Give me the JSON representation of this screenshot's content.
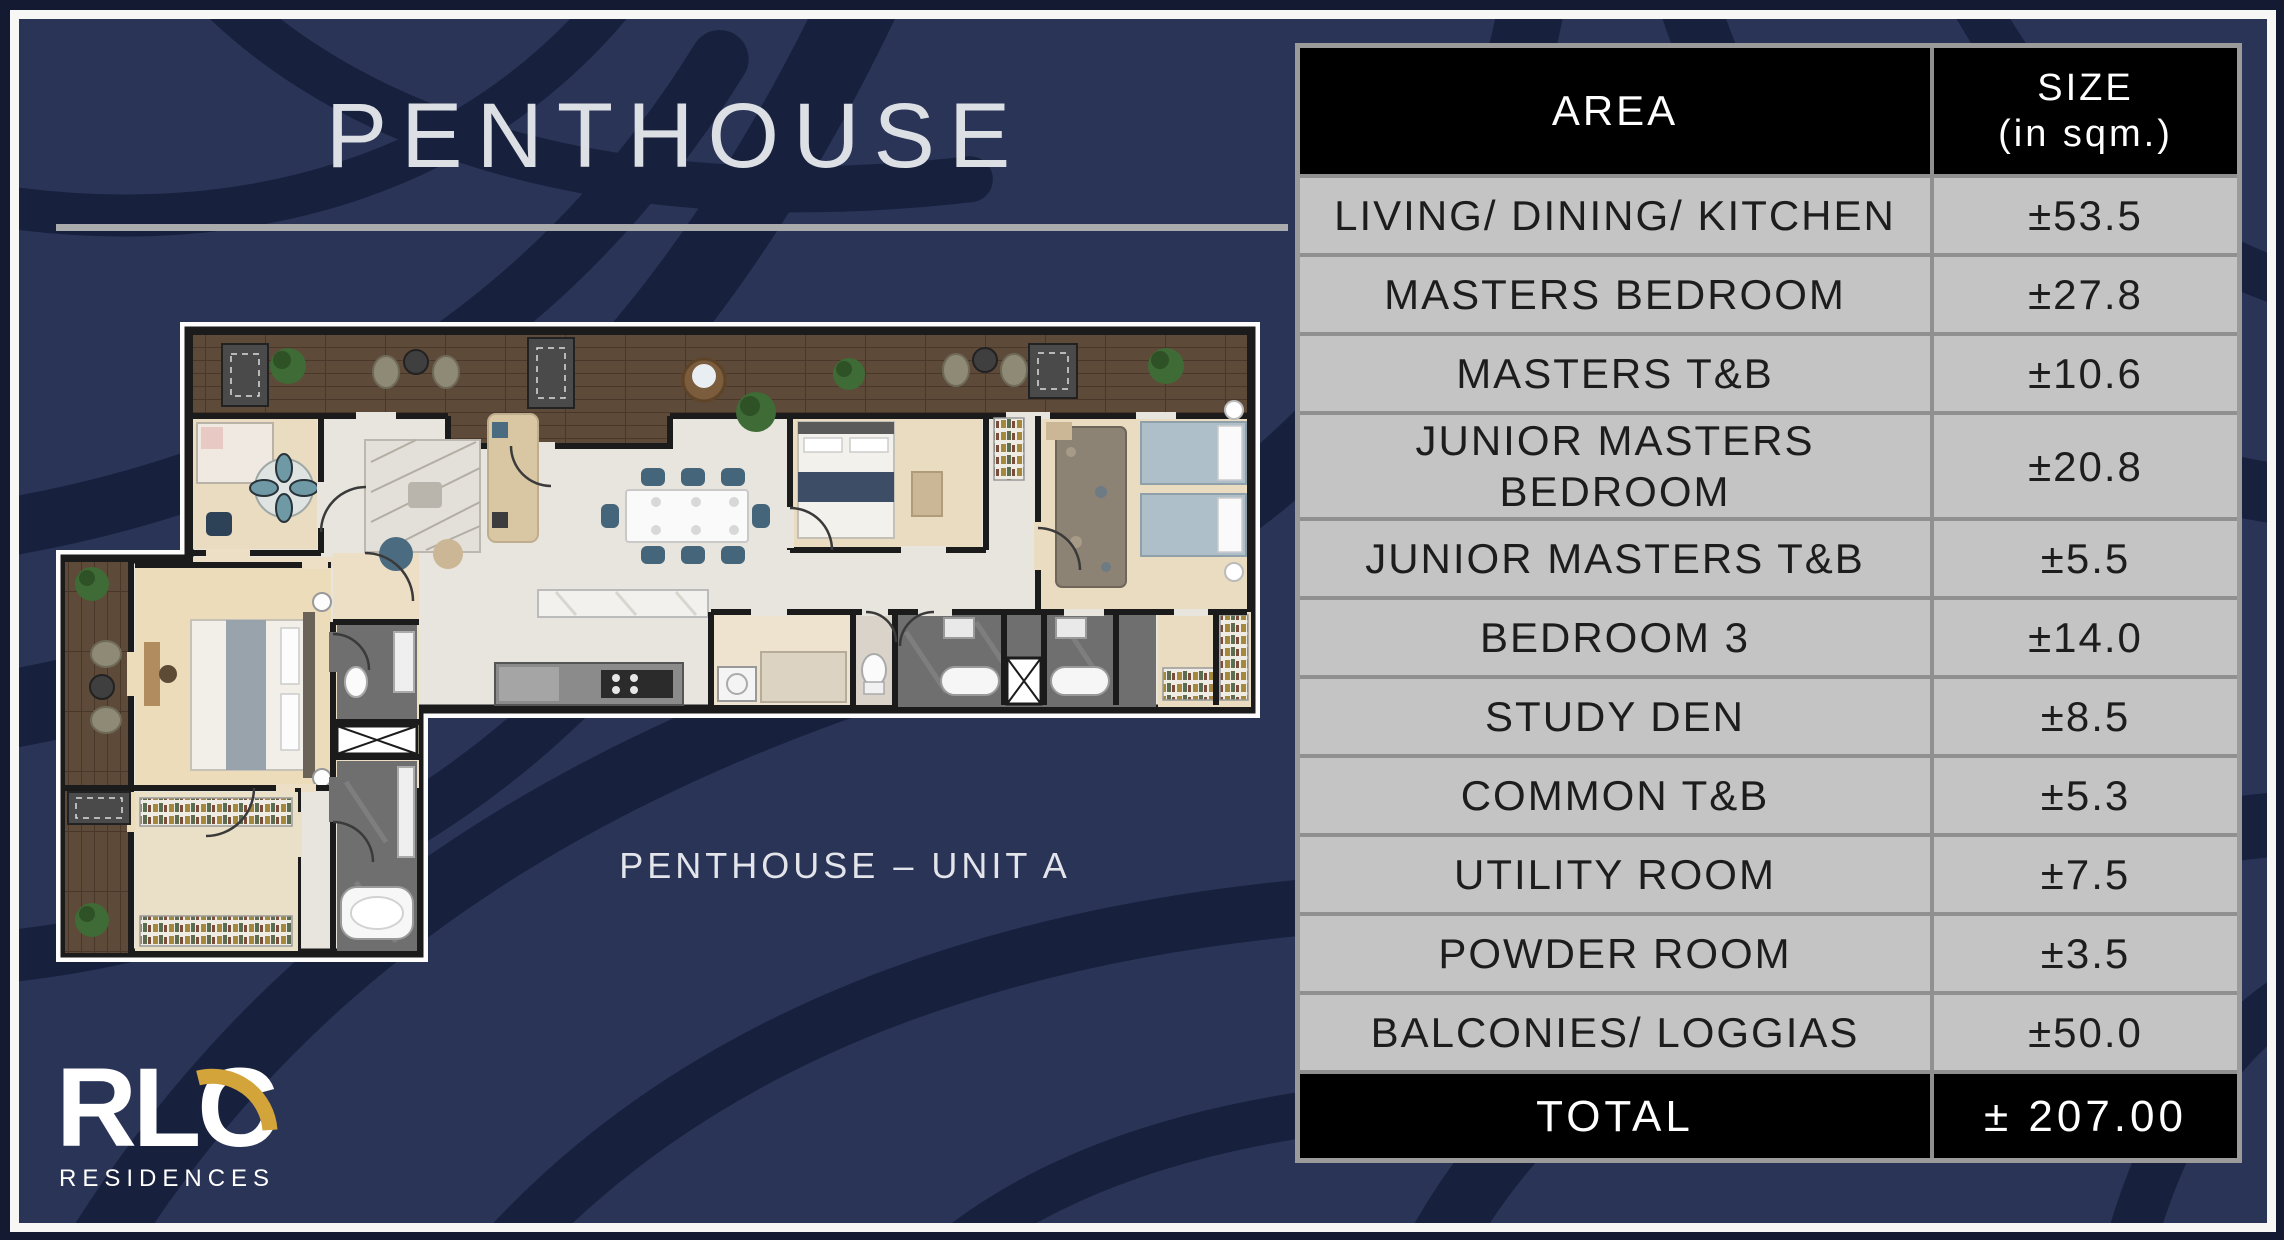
{
  "slide": {
    "title": "PENTHOUSE",
    "caption": "PENTHOUSE – UNIT A"
  },
  "logo": {
    "brand": "RLC",
    "subtitle": "RESIDENCES"
  },
  "table": {
    "header": {
      "area": "AREA",
      "size": "SIZE\n(in sqm.)"
    },
    "rows": [
      {
        "area": "LIVING/ DINING/ KITCHEN",
        "size": "±53.5"
      },
      {
        "area": "MASTERS BEDROOM",
        "size": "±27.8"
      },
      {
        "area": "MASTERS T&B",
        "size": "±10.6"
      },
      {
        "area": "JUNIOR MASTERS\nBEDROOM",
        "size": "±20.8"
      },
      {
        "area": "JUNIOR MASTERS T&B",
        "size": "±5.5"
      },
      {
        "area": "BEDROOM 3",
        "size": "±14.0"
      },
      {
        "area": "STUDY DEN",
        "size": "±8.5"
      },
      {
        "area": "COMMON T&B",
        "size": "±5.3"
      },
      {
        "area": "UTILITY ROOM",
        "size": "±7.5"
      },
      {
        "area": "POWDER ROOM",
        "size": "±3.5"
      },
      {
        "area": "BALCONIES/ LOGGIAS",
        "size": "±50.0"
      }
    ],
    "total": {
      "area": "TOTAL",
      "size": "± 207.00"
    }
  },
  "colors": {
    "page_background": "#131a31",
    "swirl_base": "#2a3457",
    "swirl_dark": "#17203d",
    "frame_white": "#f7f7f6",
    "table_row_gray": "#c4c4c4",
    "table_border_gray": "#9b9b9b",
    "table_header_black": "#000000",
    "accent_gold": "#d2a43a",
    "title_text": "#dcdfe4"
  }
}
